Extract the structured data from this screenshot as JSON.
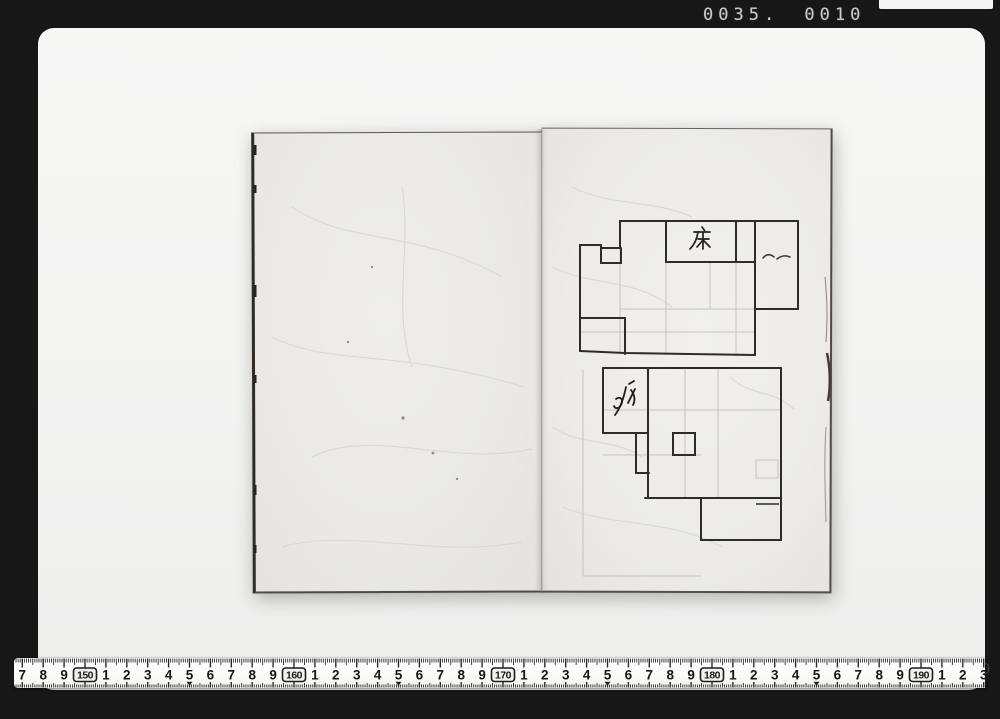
{
  "frame": {
    "counter_text": "0035. 0010"
  },
  "photo": {
    "id_number": "98002619"
  },
  "book": {
    "left_page": {
      "content": ""
    },
    "right_page": {
      "upper_plan": {
        "annotation": "床",
        "side_marks": "〜〜"
      },
      "lower_plan": {
        "annotation": "水"
      }
    }
  },
  "ruler": {
    "unit": "cm",
    "start_cm": 147,
    "end_cm": 193,
    "x_at_150_px": 71,
    "px_per_cm": 20.9,
    "boxed_labels": [
      "150",
      "160",
      "170",
      "180",
      "190"
    ],
    "visible_sequence": "7 8 9 150 1 2 3 4 5 6 7 8 9 160 1 2 3 4 5 6 7 8 9 170 1 2 3 4 5 6 7 8 9 180 1 2 3 4 5 6 7 8 9 190 1 2 3"
  },
  "colors": {
    "frame_black": "#171717",
    "photo_gray": "#f3f3f2",
    "paper": "#ebeae7",
    "ink": "#2e2b28",
    "pencil": "#c6c3bd",
    "counter_gray": "#cbcbcb"
  }
}
